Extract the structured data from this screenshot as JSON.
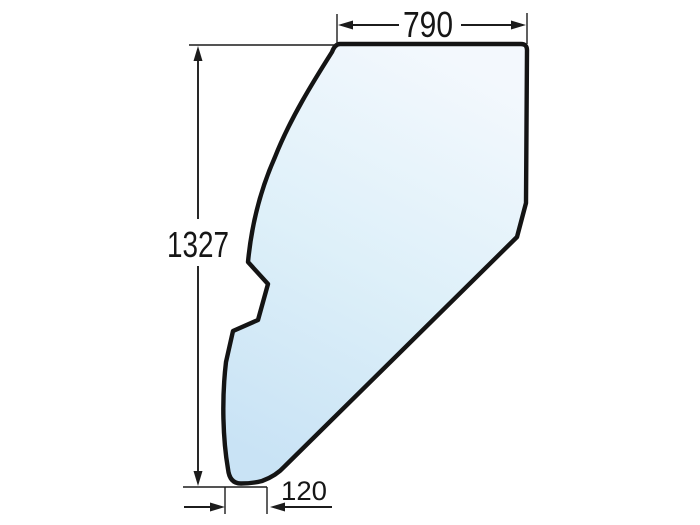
{
  "diagram": {
    "labels": {
      "top_width": "790",
      "left_height": "1327",
      "bottom_width": "120"
    },
    "colors": {
      "outline": "#141414",
      "dimension_lines": "#1c1c1c",
      "background": "#ffffff",
      "glass_top": "#f3f8fd",
      "glass_mid": "#def0f9",
      "glass_bottom": "#c9e3f5"
    }
  }
}
